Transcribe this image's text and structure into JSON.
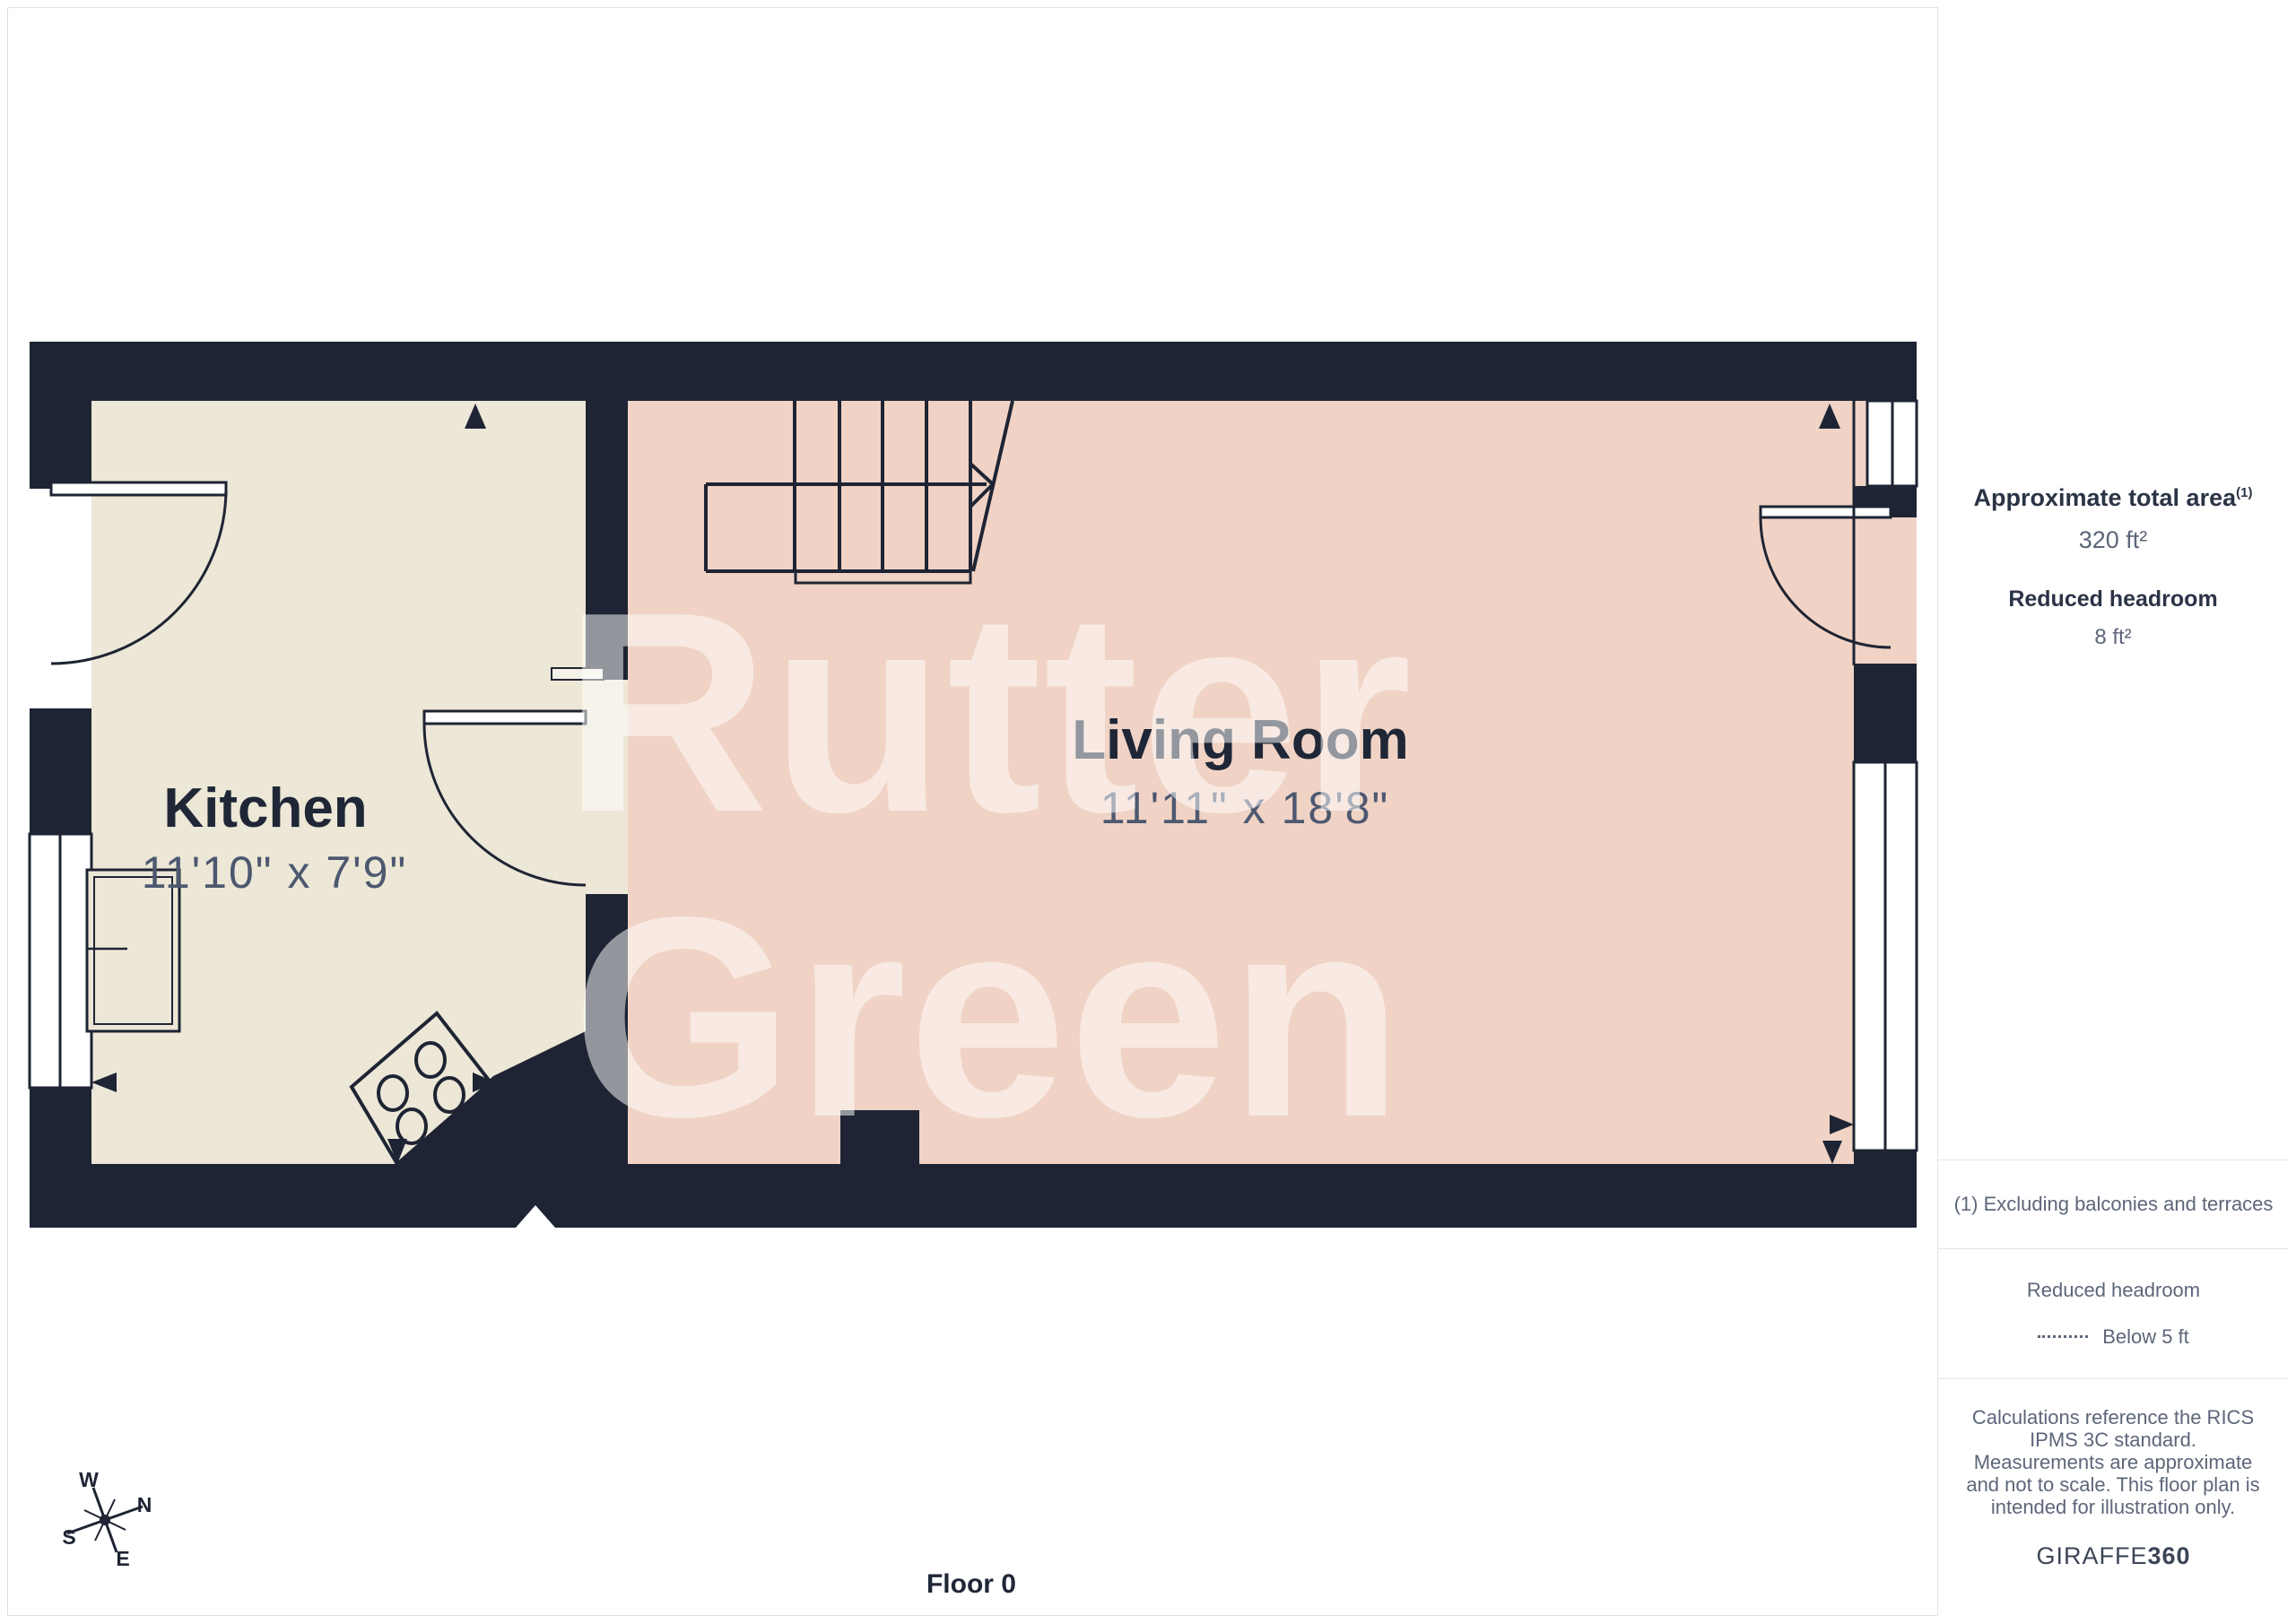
{
  "rooms": [
    {
      "name": "Kitchen",
      "dims": "11'10\" x 7'9\""
    },
    {
      "name": "Living Room",
      "dims": "11'11\" x 18'8\""
    }
  ],
  "watermark": {
    "line1": "Rutter",
    "line2": "Green"
  },
  "floor_label": "Floor 0",
  "compass": {
    "n": "N",
    "s": "S",
    "e": "E",
    "w": "W"
  },
  "sidebar": {
    "total_area_label": "Approximate total area",
    "total_area_superscript": "(1)",
    "total_area_value": "320 ft²",
    "reduced_headroom_label": "Reduced headroom",
    "reduced_headroom_value": "8 ft²",
    "footnote": "(1) Excluding balconies and terraces",
    "legend_title": "Reduced headroom",
    "legend_item": "Below 5 ft",
    "disclaimer": "Calculations reference the RICS IPMS 3C standard. Measurements are approximate and not to scale. This floor plan is intended for illustration only.",
    "brand": "GIRAFFE",
    "brand_suffix": "360"
  },
  "colors": {
    "wall": "#1e2433",
    "kitchen_floor": "#ece7d6",
    "living_floor": "#f0d3c5",
    "text_dark": "#1f2737",
    "text_gray": "#5d6679"
  }
}
